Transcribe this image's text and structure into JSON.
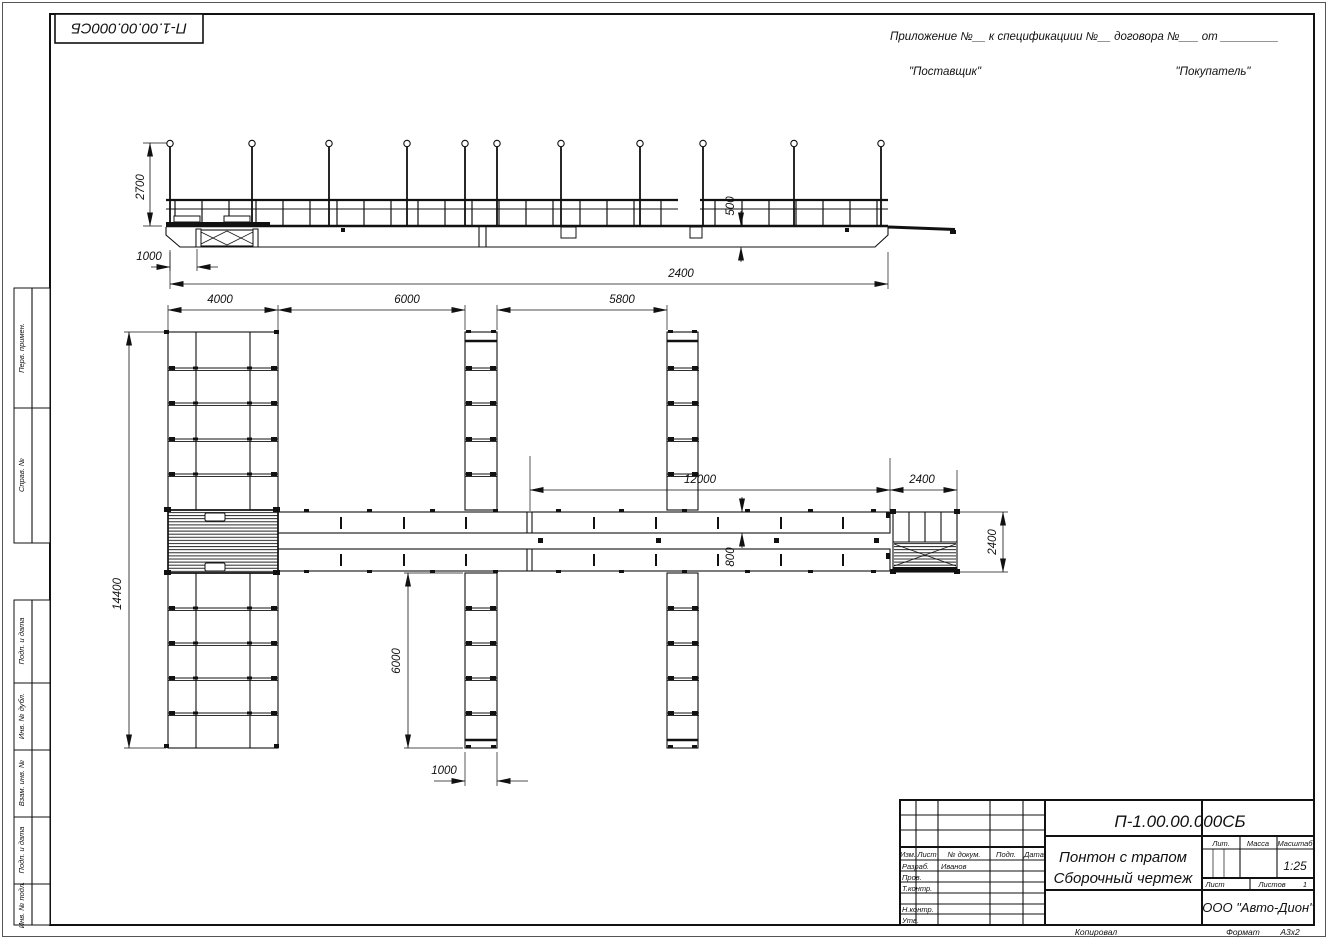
{
  "ink": "#111111",
  "paper": "#ffffff",
  "header": {
    "doc_number_top": "П-1.00.00.000СБ",
    "appendix_line": "Приложение №__    к спецификациии №__   договора №___  от _________",
    "supplier": "\"Поставщик\"",
    "buyer": "\"Покупатель\""
  },
  "margin_stamps": {
    "perv_primen": "Перв. примен.",
    "sprav_no": "Справ. №",
    "podp_data_1": "Подп. и дата",
    "inv_dubl": "Инв. № дубл.",
    "vzam_inv": "Взам. инв. №",
    "podp_data_2": "Подп. и дата",
    "inv_podl": "Инв. № подл."
  },
  "title_block": {
    "doc_number": "П-1.00.00.000СБ",
    "title_line1": "Понтон с трапом",
    "title_line2": "Сборочный чертеж",
    "company": "ООО \"Авто-Дион\"",
    "col_izm": "Изм.",
    "col_list": "Лист",
    "col_doc": "№ докум.",
    "col_podp": "Подп.",
    "col_data": "Дата",
    "row_razrab": "Разраб.",
    "row_prov": "Пров.",
    "row_tkontr": "Т.контр.",
    "row_nkontr": "Н.контр.",
    "row_utv": "Утв.",
    "razrab_name": "Иванов",
    "lit_label": "Лит.",
    "mass_label": "Масса",
    "scale_label": "Масштаб",
    "scale_value": "1:25",
    "sheet_label": "Лист",
    "sheets_label": "Листов",
    "sheets_value": "1"
  },
  "footer": {
    "copied": "Копировал",
    "format_label": "Формат",
    "format_value": "А3х2"
  },
  "dimensions": {
    "elev_post_height": "2700",
    "elev_left_offset": "1000",
    "elev_hull_height": "500",
    "elev_total": "2400",
    "plan_pier_width": "4000",
    "plan_gap1": "6000",
    "plan_gap2": "5800",
    "plan_walkway_len": "12000",
    "plan_trap_len": "2400",
    "plan_total_height": "14400",
    "plan_finger_len": "6000",
    "plan_finger_width": "1000",
    "plan_walkway_width": "800",
    "plan_trap_width": "2400"
  }
}
